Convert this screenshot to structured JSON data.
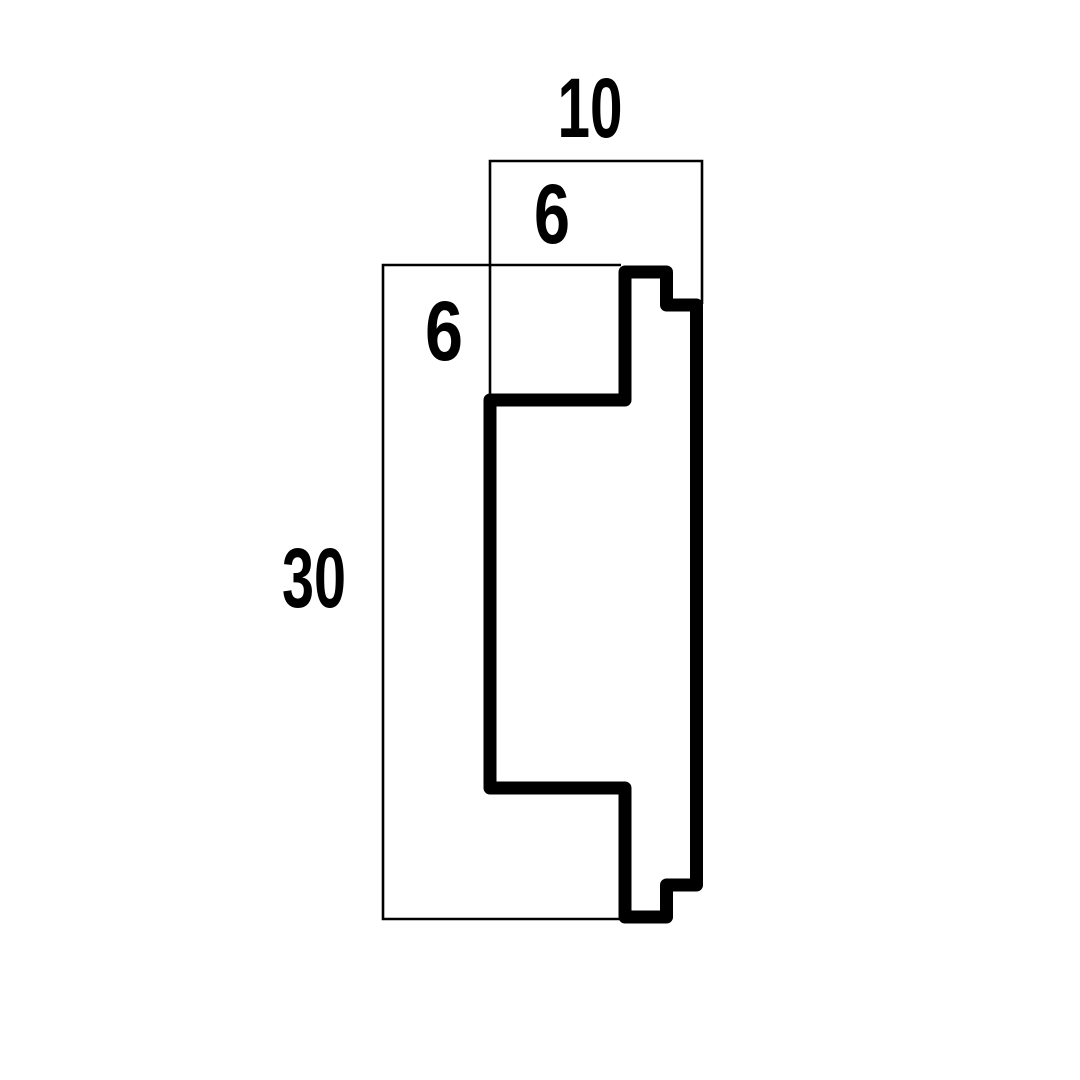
{
  "drawing": {
    "type": "profile-cross-section",
    "line_color": "#000000",
    "background_color": "#ffffff",
    "dimensions": {
      "top_width": "10",
      "top_height": "6",
      "left_inset": "6",
      "overall_height": "30"
    }
  }
}
